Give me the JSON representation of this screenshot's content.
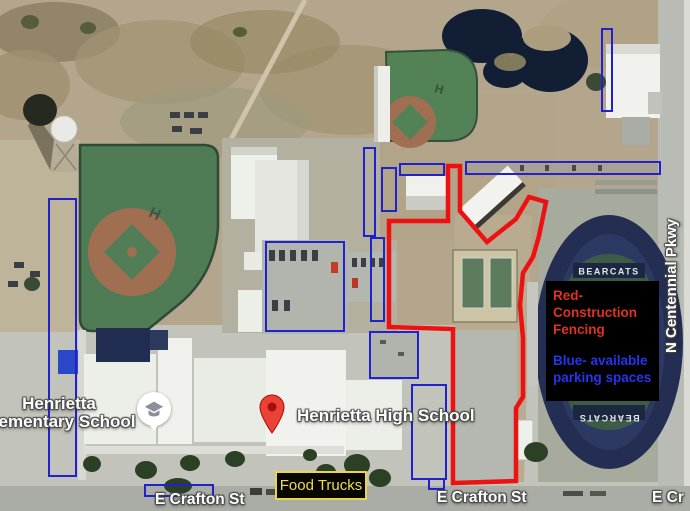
{
  "map": {
    "labels": {
      "high_school": "Henrietta High School",
      "elementary_line1": "Henrietta",
      "elementary_line2": "Elementary School",
      "food_trucks": "Food Trucks",
      "street": "E Crafton St",
      "street_edge": "E Cr",
      "parkway": "N Centennial Pkwy",
      "stadium": "BEARCATS",
      "field_letter": "H"
    },
    "legend": {
      "red_label": "Red-\nConstruction\nFencing",
      "blue_label": "Blue- available\nparking spaces",
      "red_color": "#e03222",
      "blue_color": "#2734ee",
      "background": "#000000"
    },
    "annotation_colors": {
      "construction_fence": "#ee1111",
      "parking_rectangles": "#2222cc",
      "food_trucks_box_border": "#e8d44d",
      "map_pin": "#ea4335"
    }
  }
}
